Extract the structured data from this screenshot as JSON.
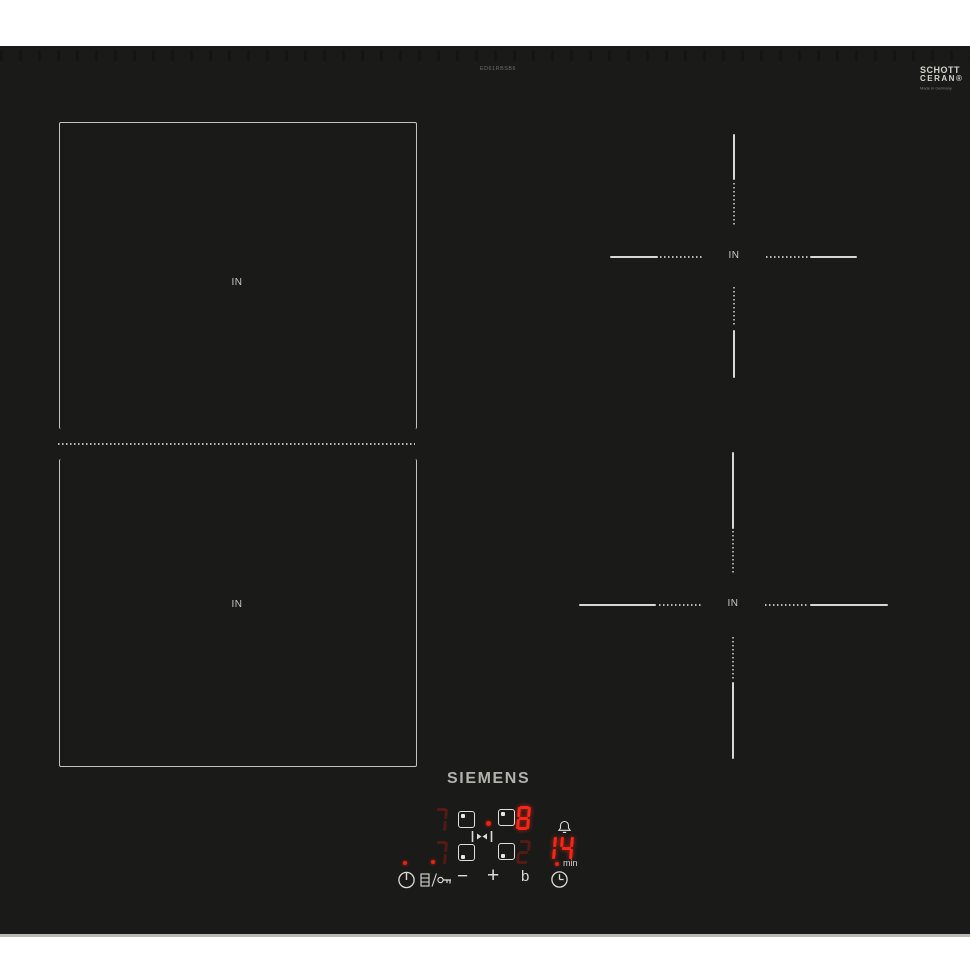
{
  "surface": {
    "model_number": "ED61RBSB6",
    "brand_logo": "SIEMENS",
    "glass_brand": {
      "line1": "SCHOTT",
      "line2": "CERAN®",
      "subtext": "Made in Germany"
    }
  },
  "zones": {
    "flex_back_label": "IN",
    "flex_front_label": "IN",
    "right_back_label": "IN",
    "right_front_label": "IN"
  },
  "controls": {
    "display": {
      "back_left": {
        "value": "7",
        "state": "dim"
      },
      "back_right": {
        "value": "8",
        "state": "bright"
      },
      "front_left": {
        "value": "7",
        "state": "dim"
      },
      "front_right": {
        "value": "2",
        "state": "dim"
      },
      "timer": {
        "value": "14",
        "state": "bright"
      }
    },
    "timer_unit": "min",
    "buttons": {
      "minus_label": "−",
      "plus_label": "+",
      "boost_label": "b"
    },
    "icons": [
      "power-icon",
      "key-lock-icon",
      "bridge-icon",
      "bell-icon",
      "clock-icon"
    ]
  },
  "colors": {
    "glass": "#1a1a18",
    "marking": "#d8d8d2",
    "led_bright": "#ff2418",
    "led_dim": "#7a1a0e",
    "indicator_red": "#ee2014"
  }
}
